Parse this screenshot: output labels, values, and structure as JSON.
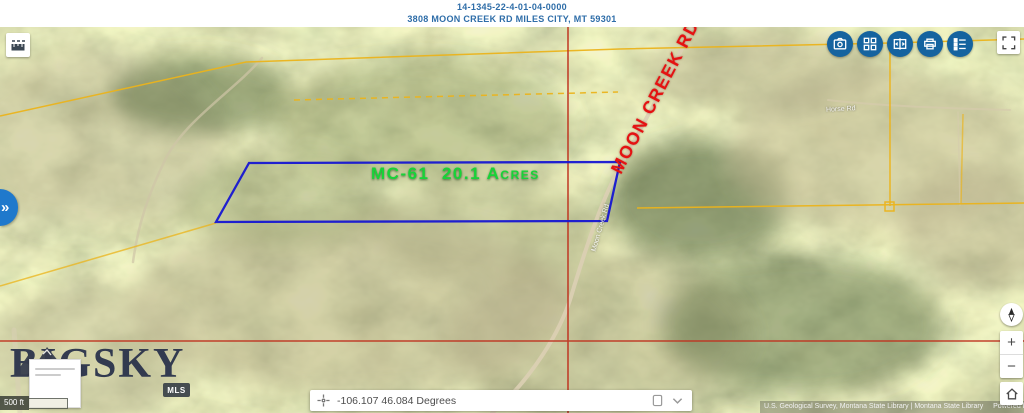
{
  "header": {
    "parcel_number": "14-1345-22-4-01-04-0000",
    "address": "3808 MOON CREEK RD MILES CITY, MT 59301"
  },
  "toolbar": {
    "icons": [
      "camera-icon",
      "apps-grid-icon",
      "swipe-compare-icon",
      "print-icon",
      "legend-icon"
    ],
    "button_color": "#15639f"
  },
  "map": {
    "parcel_label": "MC-61  20.1 Acres",
    "road_label": "MOON CREEK RD",
    "basemap_road_label": "Moon Creek Rd",
    "secondary_road_label": "Horse Rd",
    "colors": {
      "parcel_outline": "#1616d2",
      "boundary_lines": "#ebb41c",
      "section_lines": "#bf3420",
      "parcel_label_text": "#18d338",
      "road_label_text": "#e51212"
    }
  },
  "watermark": {
    "word1": "BIG",
    "word2": "SKY",
    "badge": "MLS"
  },
  "scale_bar": {
    "label": "500 ft"
  },
  "coordinate_bar": {
    "value": "-106.107 46.084 Degrees"
  },
  "zoom_controls": {
    "zoom_in": "+",
    "zoom_out": "−"
  },
  "panel_tab": {
    "chevrons": "»"
  },
  "attribution": {
    "sources": "U.S. Geological Survey, Montana State Library | Montana State Library",
    "powered_by": "Powered by Esri"
  }
}
